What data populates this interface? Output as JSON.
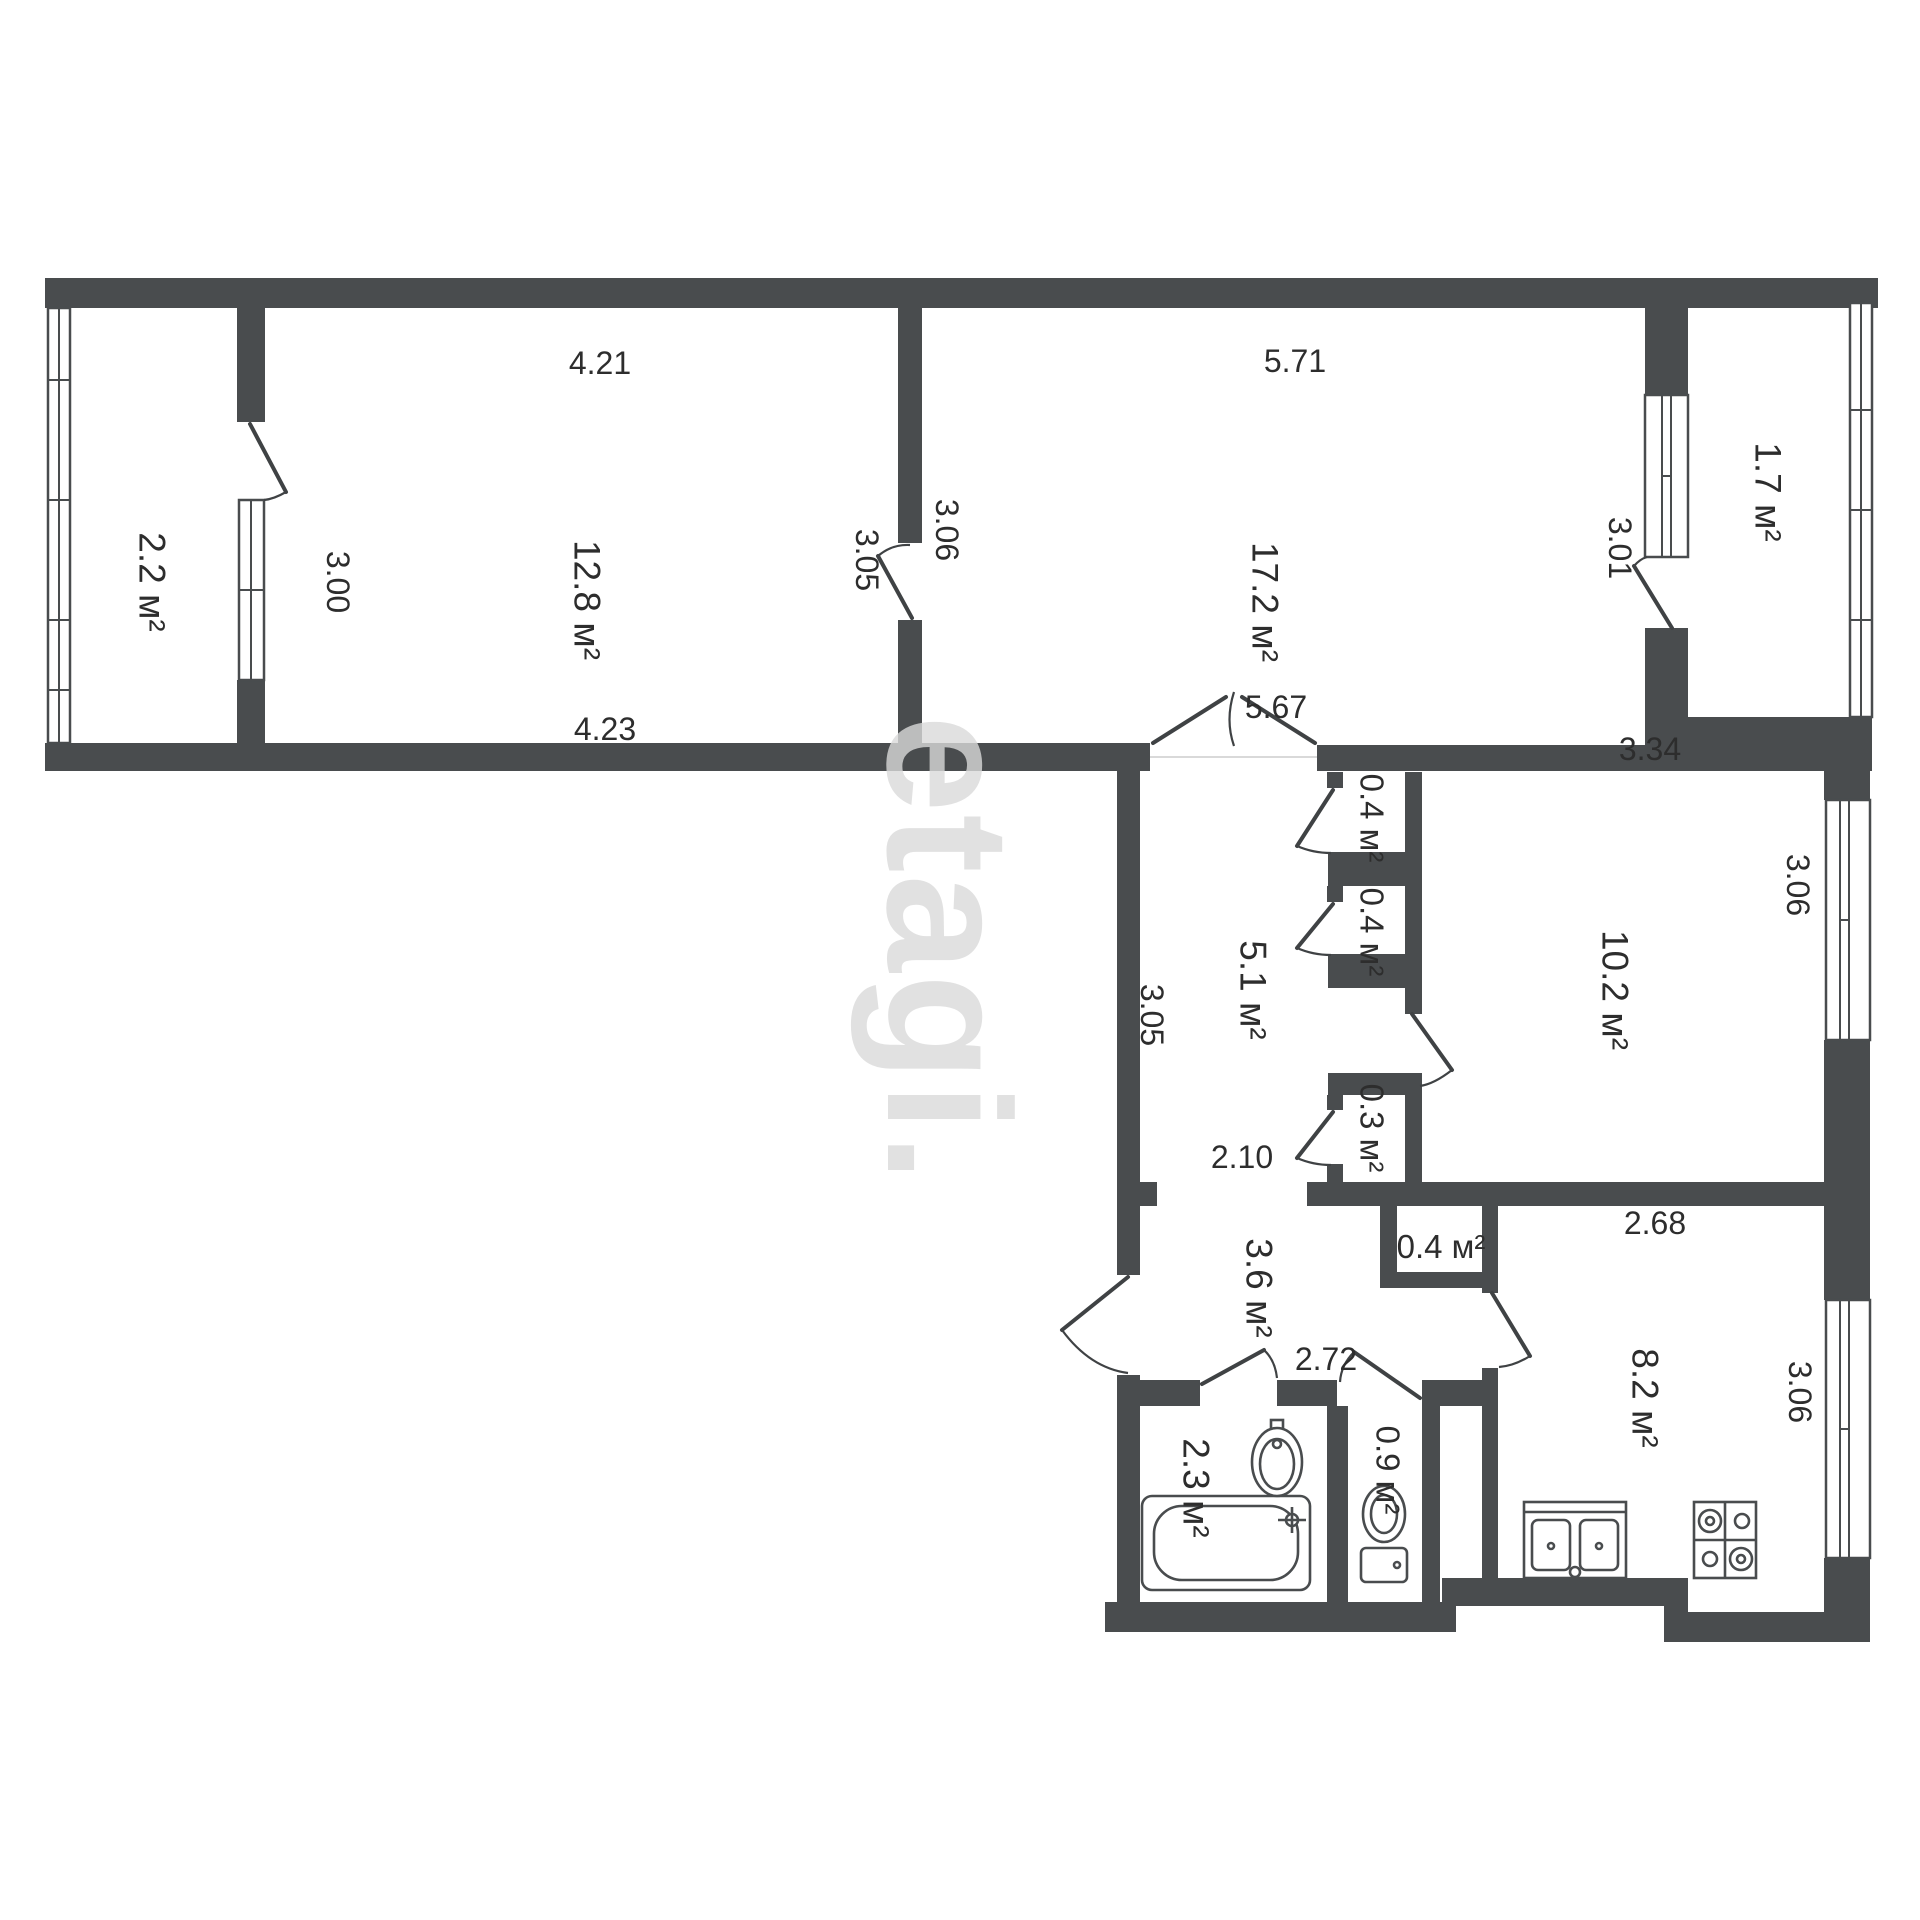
{
  "watermark": "etagi.",
  "rooms": [
    {
      "id": "balcony-left",
      "area": "2.2 м²"
    },
    {
      "id": "room-living",
      "area": "12.8 м²"
    },
    {
      "id": "room-hall-big",
      "area": "17.2 м²"
    },
    {
      "id": "balcony-right",
      "area": "1.7 м²"
    },
    {
      "id": "corridor",
      "area": "5.1 м²"
    },
    {
      "id": "closet-top",
      "area": "0.4 м²"
    },
    {
      "id": "closet-mid",
      "area": "0.4 м²"
    },
    {
      "id": "closet-small",
      "area": "0.3 м²"
    },
    {
      "id": "bedroom",
      "area": "10.2 м²"
    },
    {
      "id": "closet-kitchen",
      "area": "0.4 м²"
    },
    {
      "id": "hallway",
      "area": "3.6 м²"
    },
    {
      "id": "bathroom",
      "area": "2.3 м²"
    },
    {
      "id": "toilet",
      "area": "0.9 м²"
    },
    {
      "id": "kitchen",
      "area": "8.2 м²"
    }
  ],
  "dims": [
    {
      "id": "room1-top",
      "text": "4.21"
    },
    {
      "id": "room1-bottom",
      "text": "4.23"
    },
    {
      "id": "balcony-left-door",
      "text": "3.00"
    },
    {
      "id": "room1-door",
      "text": "3.05"
    },
    {
      "id": "room2-left",
      "text": "3.06"
    },
    {
      "id": "room2-top",
      "text": "5.71"
    },
    {
      "id": "balcony-right-door",
      "text": "3.01"
    },
    {
      "id": "opening-width",
      "text": "5.67"
    },
    {
      "id": "corridor-depth",
      "text": "3.05"
    },
    {
      "id": "corridor-width",
      "text": "2.10"
    },
    {
      "id": "bedroom-top",
      "text": "3.34"
    },
    {
      "id": "bedroom-side",
      "text": "3.06"
    },
    {
      "id": "kitchen-top",
      "text": "2.68"
    },
    {
      "id": "hallway-width",
      "text": "2.72"
    },
    {
      "id": "kitchen-side",
      "text": "3.06"
    }
  ]
}
